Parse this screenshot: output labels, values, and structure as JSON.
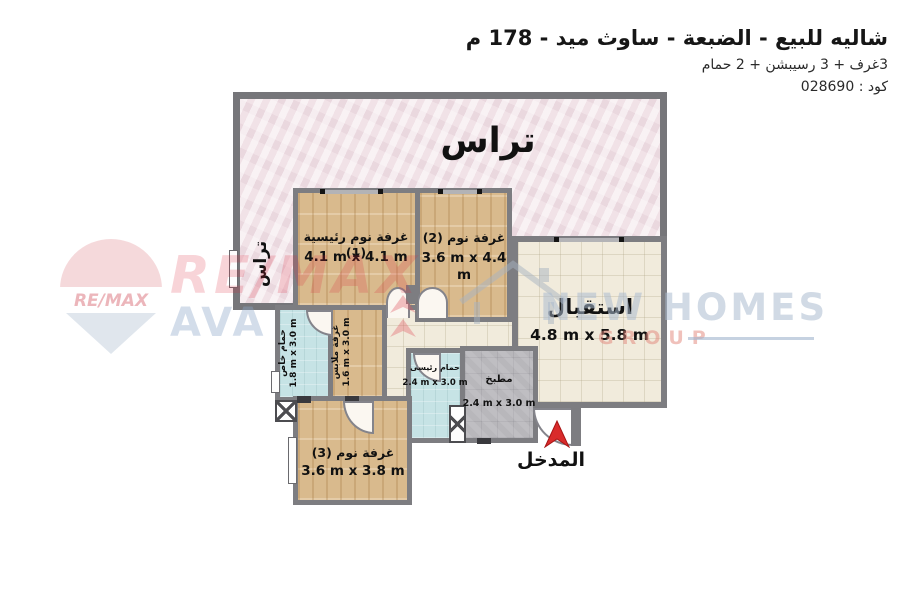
{
  "header": {
    "title": "شاليه للبيع - الضبعة - ساوث ميد - 178 م",
    "subtitle": "3غرف + 3 رسيبشن + 2 حمام",
    "code": "كود : 028690"
  },
  "plan": {
    "terrace": {
      "label": "تراس"
    },
    "terrace_side": {
      "label": "تراس"
    },
    "bedroom1": {
      "name": "غرفة نوم رئيسية (1)",
      "dims": "4.1 m x 4.1 m"
    },
    "bedroom2": {
      "name": "غرفة نوم (2)",
      "dims": "3.6 m x 4.4 m"
    },
    "reception": {
      "name": "استقبال",
      "dims": "4.8 m x 5.8 m"
    },
    "private_bath": {
      "name": "حمام خاص",
      "dims": "1.8 m x 3.0 m"
    },
    "dressing": {
      "name": "غرفة ملابس",
      "dims": "1.6 m x 3.0 m"
    },
    "main_bath": {
      "name": "حمام رئيسى",
      "dims": "2.4 m x 3.0 m"
    },
    "kitchen": {
      "name": "مطبخ",
      "dims": "2.4 m x 3.0 m"
    },
    "bedroom3": {
      "name": "غرفة نوم (3)",
      "dims": "3.6 m x 3.8 m"
    },
    "entrance": {
      "label": "المدخل"
    }
  },
  "watermarks": {
    "balloon_text": "RE/MAX",
    "remax_text": "RE/MAX",
    "ava_text": "AVA",
    "newhomes_text": "NEW HOMES",
    "group_text": "GROUP"
  },
  "colors": {
    "wall": "#7d7d81",
    "terrace_floor": "#f1e2e7",
    "wood_floor": "#d9ba8d",
    "tile_floor": "#f1ebdc",
    "bath_floor": "#c6e3e5",
    "kitchen_floor": "#b8b7bb",
    "entrance_arrow": "#d92b2b"
  }
}
